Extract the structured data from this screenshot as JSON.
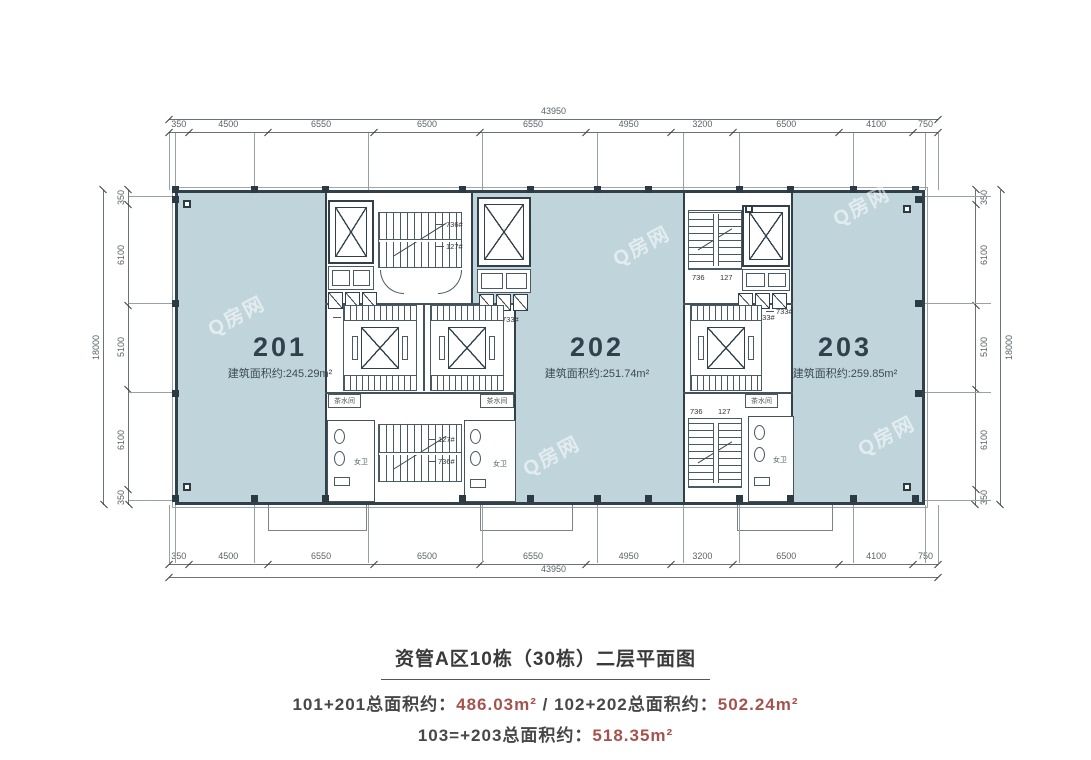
{
  "caption": {
    "title": "资管A区10栋（30栋）二层平面图",
    "line2": {
      "label1": "101+201总面积约：",
      "value1": "486.03m²",
      "sep": " / ",
      "label2": "102+202总面积约：",
      "value2": "502.24m²"
    },
    "line3": {
      "label": "103=+203总面积约：",
      "value": "518.35m²"
    }
  },
  "units": [
    {
      "number": "201",
      "area": "建筑面积约:245.29m²"
    },
    {
      "number": "202",
      "area": "建筑面积约:251.74m²"
    },
    {
      "number": "203",
      "area": "建筑面积约:259.85m²"
    }
  ],
  "dimensions": {
    "top": {
      "total": "43950",
      "segments": [
        "350",
        "4500",
        "6550",
        "6500",
        "6550",
        "4950",
        "3200",
        "6500",
        "4100",
        "750"
      ]
    },
    "bottom": {
      "total": "43950",
      "segments": [
        "350",
        "4500",
        "6550",
        "6500",
        "6550",
        "4950",
        "3200",
        "6500",
        "4100",
        "750"
      ]
    },
    "left": {
      "total": "18000",
      "segments": [
        "350",
        "6100",
        "5100",
        "6100",
        "350"
      ]
    },
    "right": {
      "total": "18000",
      "segments": [
        "350",
        "6100",
        "5100",
        "6100",
        "350"
      ]
    }
  },
  "annotations": {
    "stair_736": "736#",
    "stair_127": "127#",
    "vent_733": "733#",
    "stair_736_plain": "736",
    "stair_127_plain": "127",
    "restroom_f": "女卫",
    "pantry": "茶水间"
  },
  "watermark": "Q房网",
  "colors": {
    "unit_fill": "#c0d4db",
    "wall": "#31404a",
    "accent_red": "#a3544e",
    "dim_text": "#5a6468"
  }
}
